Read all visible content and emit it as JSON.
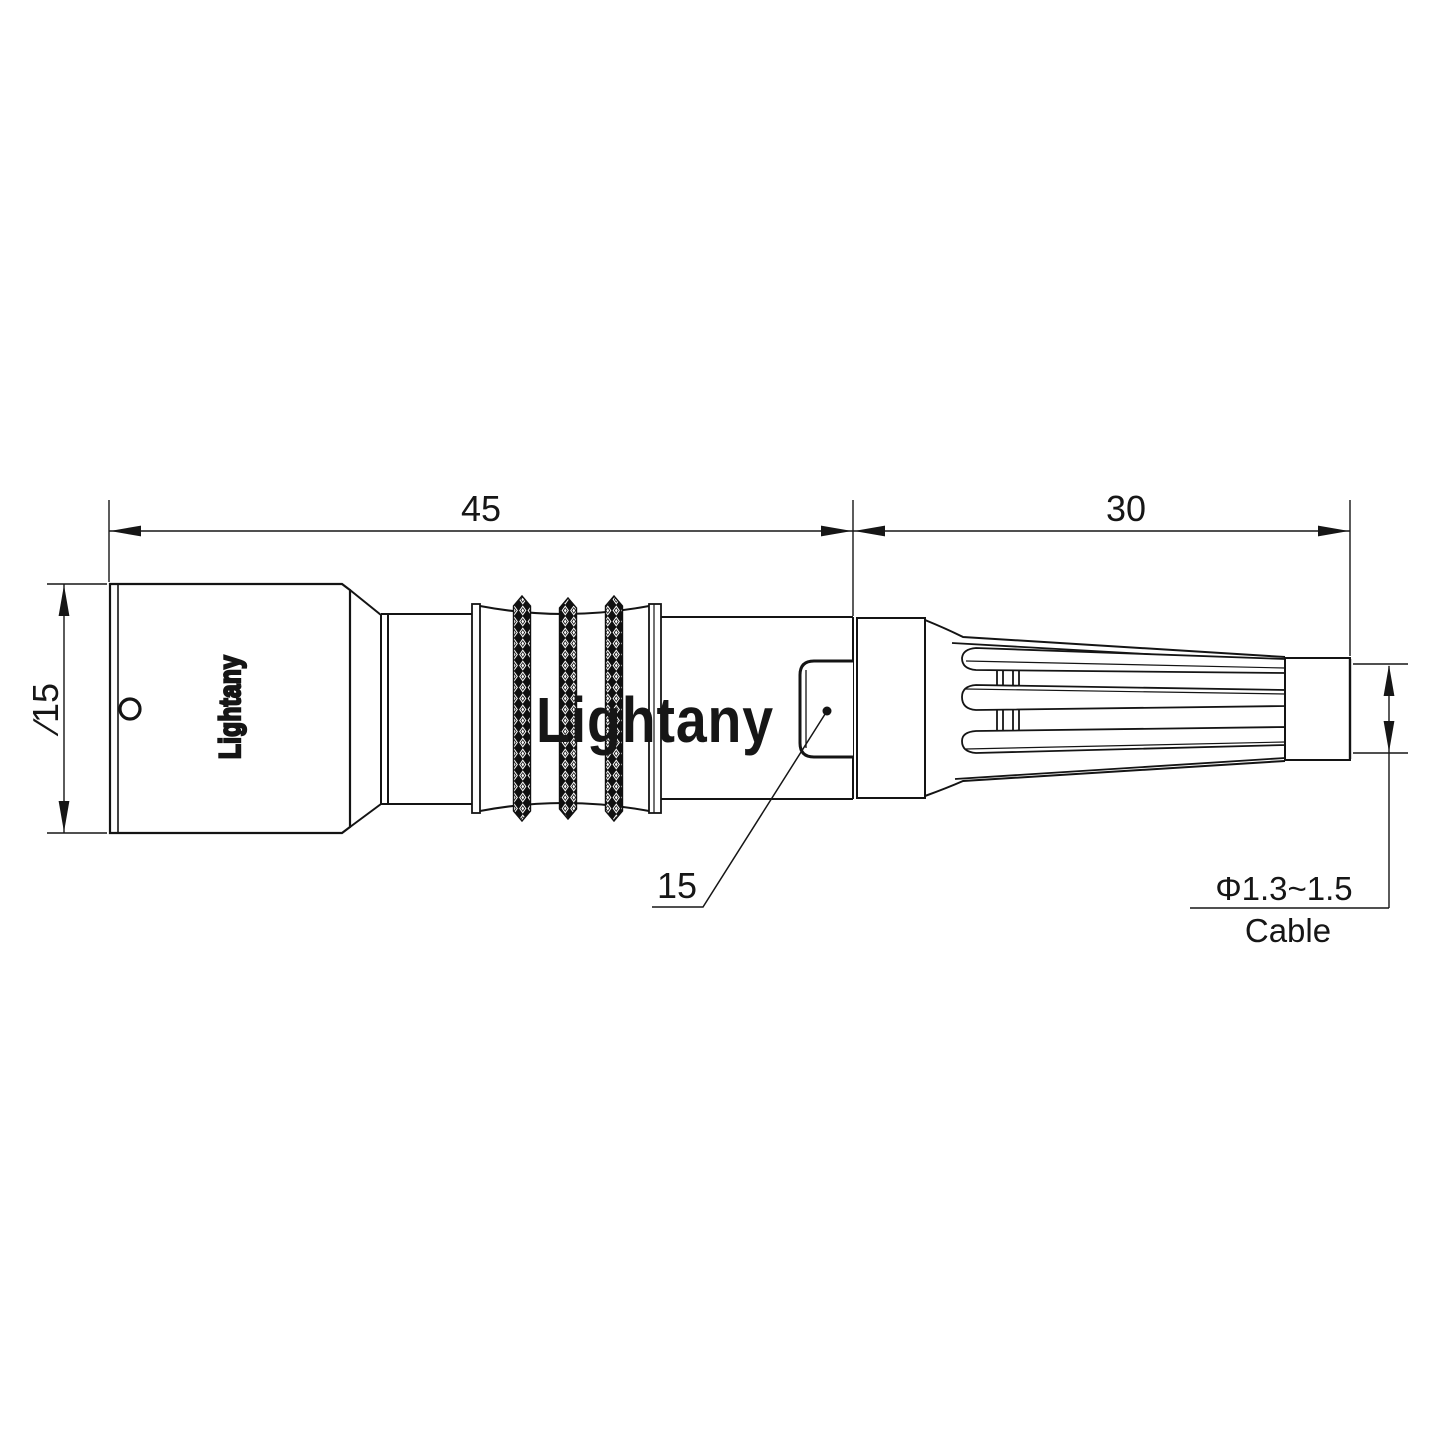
{
  "drawing": {
    "title_hint": "connector outline drawing",
    "brand_label": "Lightany",
    "watermark": "Lightany",
    "dimensions": {
      "total_length": "45",
      "boot_length": "30",
      "body_diameter": "∕15",
      "window_detail": "15",
      "cable_diameter": "Φ1.3~1.5",
      "cable_label": "Cable"
    },
    "colors": {
      "line": "#141414",
      "watermark_pink": "#d15c5c",
      "background": "#ffffff"
    }
  }
}
